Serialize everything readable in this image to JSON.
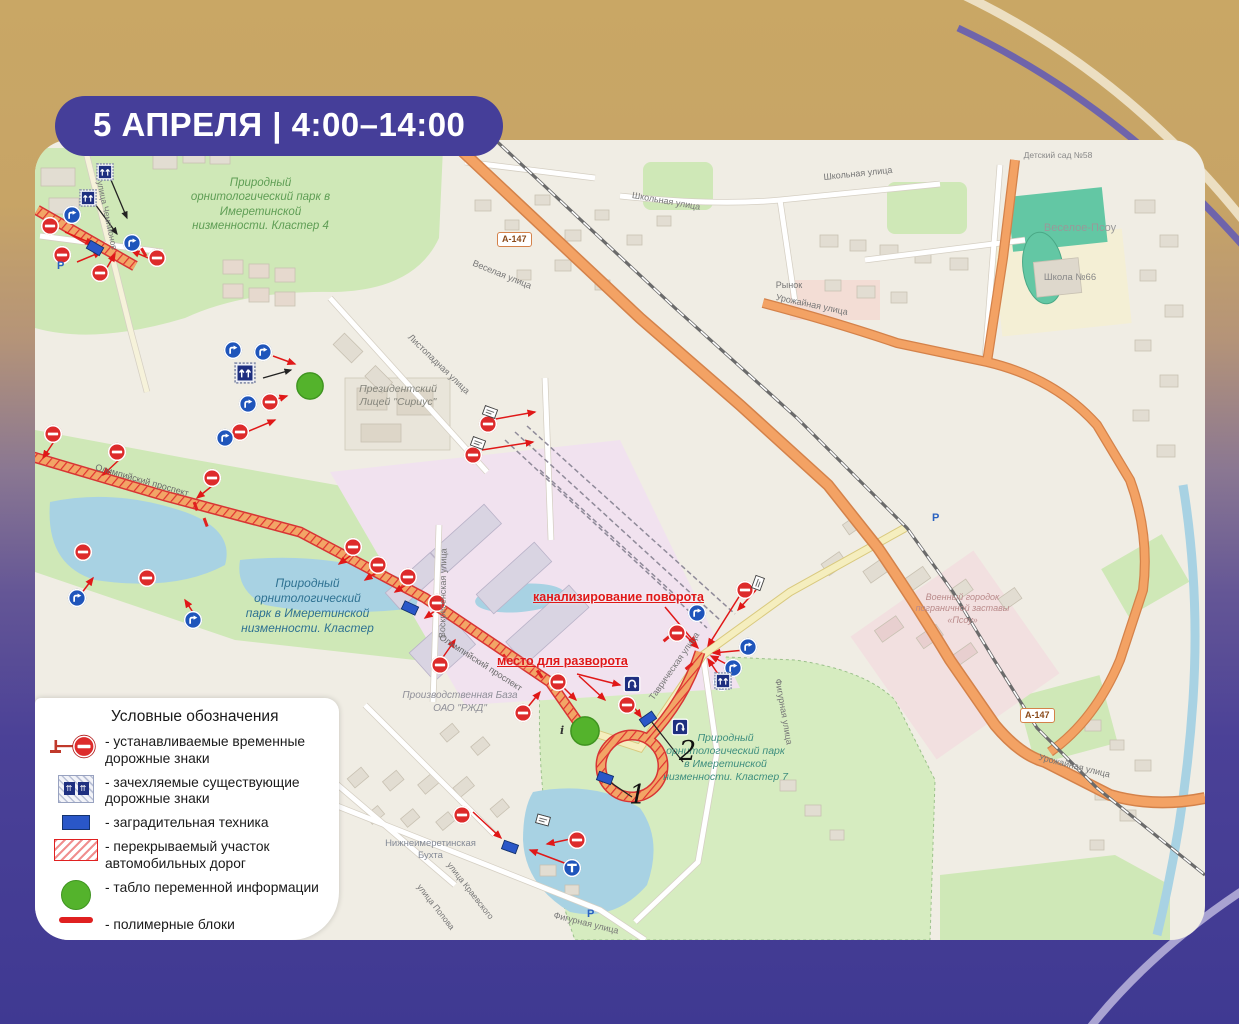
{
  "badge": {
    "text": "5 АПРЕЛЯ | 4:00–14:00"
  },
  "legend": {
    "title": "Условные обозначения",
    "items": [
      {
        "icon": "temporary-sign-icon",
        "label": "- устанавливаемые временные дорожные знаки"
      },
      {
        "icon": "covered-sign-icon",
        "label": "- зачехляемые существующие дорожные знаки"
      },
      {
        "icon": "barrier-equipment-icon",
        "label": "- заградительная техника"
      },
      {
        "icon": "closed-road-section-icon",
        "label": "- перекрываемый участок автомобильных дорог"
      },
      {
        "icon": "variable-message-board-icon",
        "label": "- табло переменной информации"
      },
      {
        "icon": "polymer-blocks-icon",
        "label": "- полимерные блоки"
      }
    ]
  },
  "map": {
    "region_labels": {
      "park_cluster4": "Природный орнитологический парк в Имеретинской низменности. Кластер 4",
      "park_cluster": "Природный орнитологический парк в Имеретинской низменности. Кластер",
      "park_cluster7": "Природный орнитологический парк в Имеретинской низменности. Кластер 7",
      "lyceum": "Президентский Лицей \"Сириус\"",
      "rzd_base": "Производственная База ОАО \"РЖД\"",
      "military": "Военный городок пограничной заставы «Псоу»",
      "veseloe_psou": "Веселое-Псоу",
      "school66": "Школа №66",
      "kindergarten58": "Детский сад №58",
      "rynok": "Рынок",
      "bukhta": "Нижнеимеретинская Бухта"
    },
    "street_labels": {
      "olimpiysky1": "Олимпийский проспект",
      "olimpiysky2": "Олимпийский проспект",
      "shkolnaya1": "Школьная улица",
      "shkolnaya2": "Школьная улица",
      "urozhaynaya1": "Урожайная улица",
      "urozhaynaya2": "Урожайная улица",
      "veselaya": "Веселая улица",
      "voskresenskaya": "Воскресенская улица",
      "tavricheskaya": "Таврическая улица",
      "figurnaya1": "Фигурная улица",
      "figurnaya2": "Фигурная улица",
      "kraevskogo": "улица Краевского",
      "popova": "улица Попова",
      "chempionov": "улица Чемпионов",
      "listopadnaya": "Листопадная улица",
      "highway1": "А-147",
      "highway2": "А-147"
    },
    "annotations": {
      "channeling": "канализирование поворота",
      "turnaround": "место для разворота",
      "marker1": "1",
      "marker2": "2"
    },
    "poi": {
      "parking": "Р",
      "info": "i"
    }
  },
  "colors": {
    "accent_purple": "#453e99",
    "closure_red": "#e02020",
    "sign_blue": "#1f55bb",
    "covered_navy": "#1e2f80",
    "board_green": "#54b32c",
    "trunk_orange": "#f3a264",
    "background_top": "#c9a765",
    "background_bottom": "#3f3992"
  }
}
